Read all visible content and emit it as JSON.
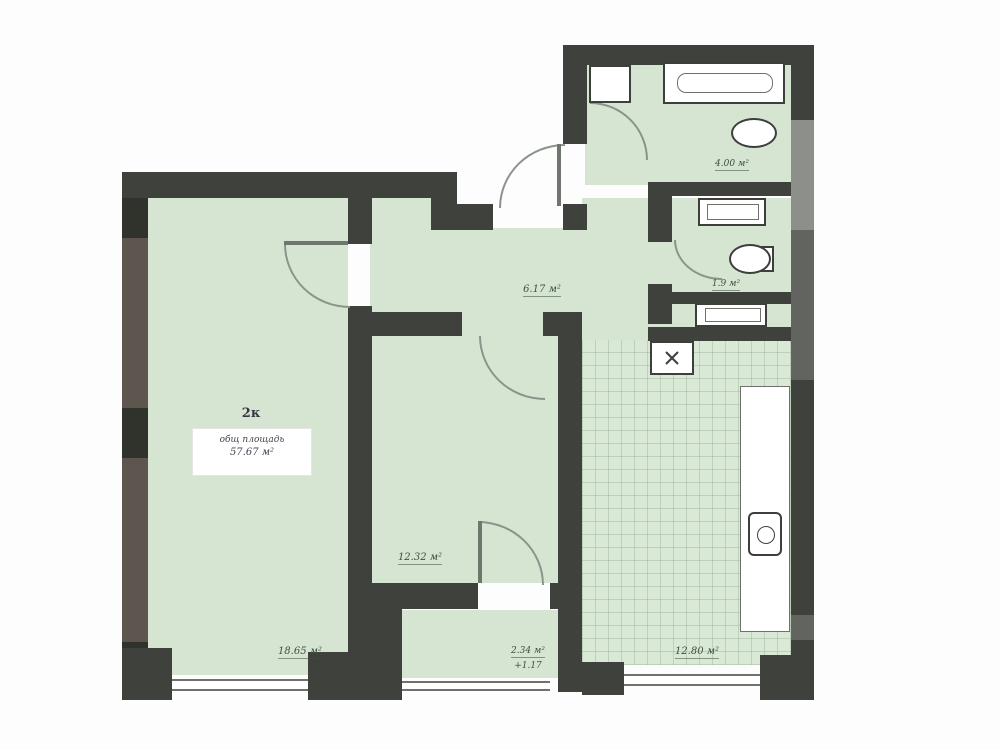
{
  "plan": {
    "summary": {
      "apartment_type_label": "2к",
      "total_area_caption": "общ площадь",
      "total_area_value": "57.67 м²"
    },
    "rooms": [
      {
        "id": "living-room",
        "area_label": "18.65 м²"
      },
      {
        "id": "bedroom",
        "area_label": "12.32 м²"
      },
      {
        "id": "hallway",
        "area_label": "6.17 м²"
      },
      {
        "id": "kitchen",
        "area_label": "12.80 м²"
      },
      {
        "id": "bathroom",
        "area_label": "4.00 м²"
      },
      {
        "id": "wc",
        "area_label": "1.9 м²"
      },
      {
        "id": "balcony",
        "area_label": "2.34 м²",
        "coefficient_label": "+1.17"
      }
    ],
    "colors": {
      "room_fill": "#d6e5d2",
      "kitchen_tile_fill": "#dae8d6",
      "wall_dark": "#3f423c",
      "wall_gray": "#62655f",
      "label_text": "#3f4f42",
      "background": "#fdfdfd"
    },
    "fixtures": [
      "bathtub",
      "shelf-cabinet",
      "washbasin",
      "washing-machine",
      "toilet",
      "washing-machine-2",
      "kitchen-counter",
      "kitchen-sink",
      "vent-shaft"
    ]
  }
}
